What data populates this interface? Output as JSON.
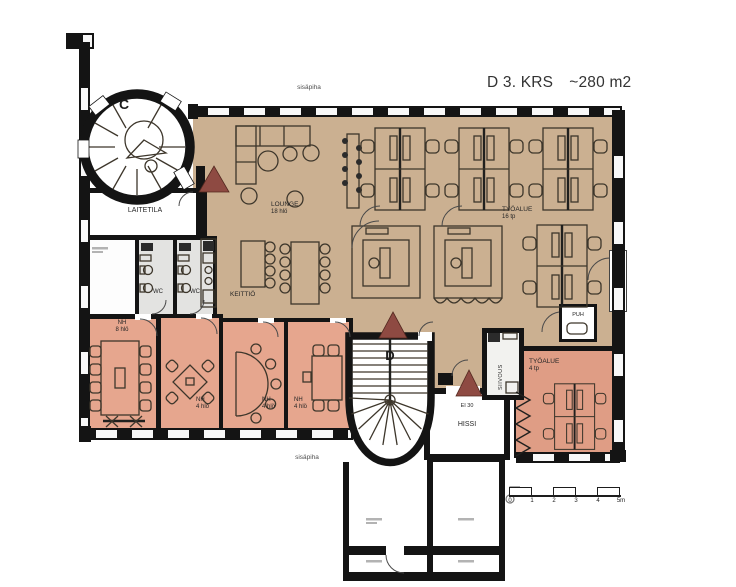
{
  "title": {
    "name": "D 3. KRS",
    "area": "~280 m2"
  },
  "site_labels": {
    "courtyard_top": "sisäpiha",
    "courtyard_bottom": "sisäpiha"
  },
  "stairwells": {
    "c": "C",
    "d": "D"
  },
  "rooms": {
    "laitetila": {
      "label": "LAITETILA"
    },
    "lounge": {
      "label": "LOUNGE",
      "capacity": "18 hlö"
    },
    "tyoalue_16": {
      "label": "TYÖALUE",
      "capacity": "16 tp"
    },
    "keittio": {
      "label": "KEITTIÖ"
    },
    "wc_left": {
      "label": "WC"
    },
    "wc_right": {
      "label": "WC"
    },
    "nh_8": {
      "label": "NH",
      "capacity": "8 hlö"
    },
    "nh_4a": {
      "label": "NH",
      "capacity": "4 hlö"
    },
    "nh_4b": {
      "label": "NH",
      "capacity": "4 hlö"
    },
    "nh_4c": {
      "label": "NH",
      "capacity": "4 hlö"
    },
    "hissi": {
      "label": "HISSI",
      "fire_rating": "EI 30"
    },
    "siivous": {
      "label": "SIIVOUS"
    },
    "puh": {
      "label": "PUH"
    },
    "tyoalue_4": {
      "label": "TYÖALUE",
      "capacity": "4 tp"
    }
  },
  "scale_bar": {
    "ticks": [
      "0",
      "1",
      "2",
      "3",
      "4",
      "5m"
    ]
  },
  "colors": {
    "open_area": "#cbb091",
    "meeting_room": "#e6a68e",
    "work_area_small": "#df9d85",
    "wc_floor": "#e3e3e1",
    "siivous_floor": "#f2f2ef",
    "alert_triangle": "#8e4a42",
    "wall": "#141414"
  }
}
